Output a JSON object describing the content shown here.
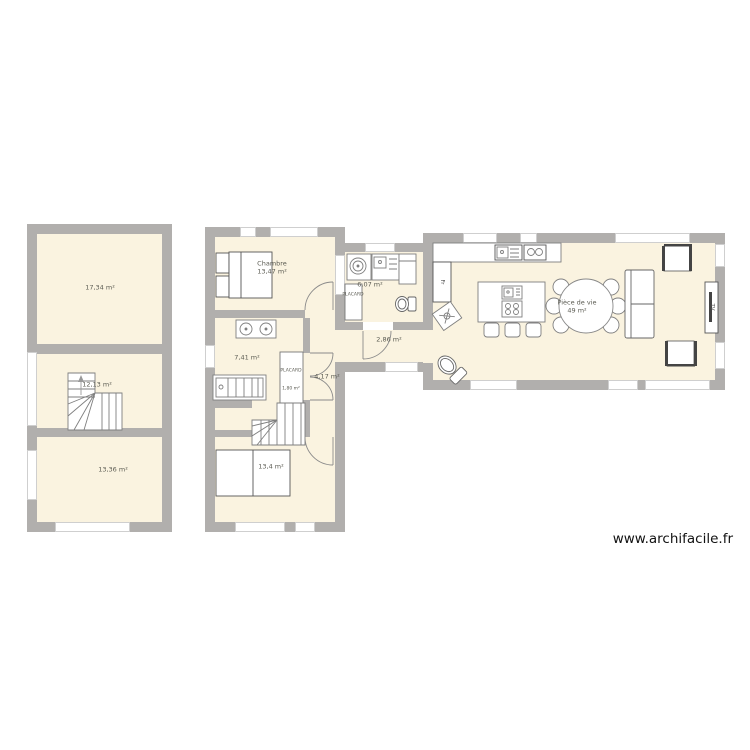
{
  "watermark": "www.archifacile.fr",
  "colors": {
    "wall": "#b1afad",
    "room_fill": "#faf3e0",
    "furniture_stroke": "#7f7f7f"
  },
  "rooms": {
    "a1": {
      "area": "17,34 m²"
    },
    "a2": {
      "area": "12,13 m²"
    },
    "a3": {
      "area": "13,36 m²"
    },
    "chambre": {
      "name": "Chambre",
      "area": "13,47 m²"
    },
    "bath": {
      "area": "7,41 m²"
    },
    "placard_main": {
      "name": "PLACARD",
      "area": "1,80 m²"
    },
    "hall_b": {
      "area": "4,17 m²"
    },
    "b4": {
      "area": "13,4 m²"
    },
    "utility": {
      "area": "6,07 m²"
    },
    "placard_small": {
      "name": "PLACARD"
    },
    "corridor": {
      "area": "2,86 m²"
    },
    "living": {
      "name": "Pièce de vie",
      "area": "49 m²"
    }
  },
  "furniture": {
    "fridge_label": "Fr",
    "tv_label": "TV"
  }
}
